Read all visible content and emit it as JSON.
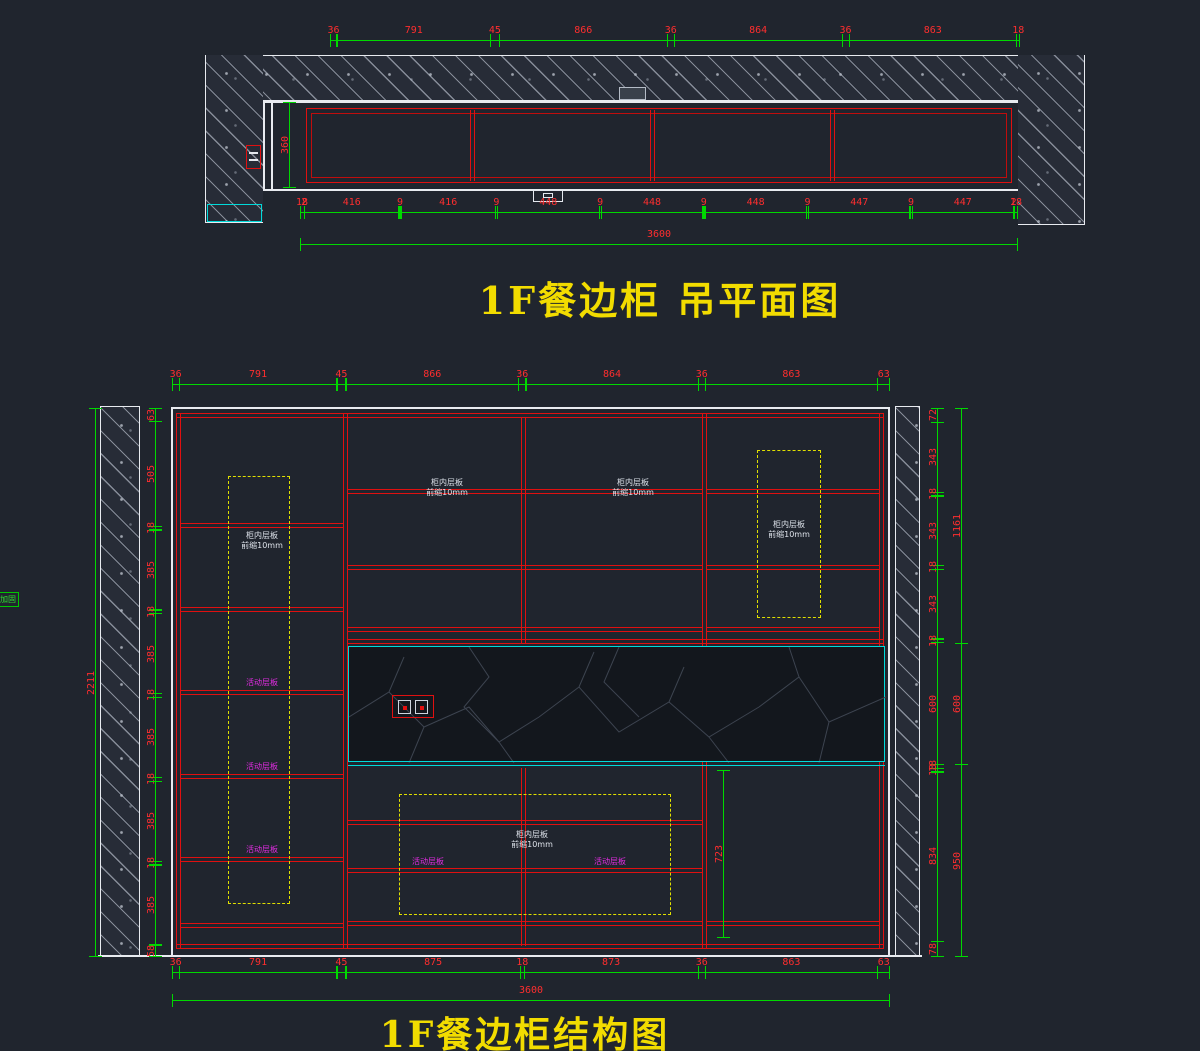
{
  "plan": {
    "title": "1F餐边柜  吊平面图",
    "dims": {
      "top": [
        "36",
        "791",
        "45",
        "866",
        "36",
        "864",
        "36",
        "863",
        "18"
      ],
      "bottom": [
        "18",
        "2",
        "416",
        "9",
        "416",
        "9",
        "448",
        "9",
        "448",
        "9",
        "448",
        "9",
        "447",
        "9",
        "447",
        "2",
        "18"
      ],
      "total": [
        "3600"
      ],
      "depth": [
        "360"
      ]
    }
  },
  "elevation": {
    "title": "1F餐边柜结构图",
    "dims": {
      "top": [
        "36",
        "791",
        "45",
        "866",
        "36",
        "864",
        "36",
        "863",
        "63"
      ],
      "bottom": [
        "36",
        "791",
        "45",
        "875",
        "18",
        "873",
        "36",
        "863",
        "63"
      ],
      "total": [
        "3600"
      ],
      "left_outer": [
        "2211"
      ],
      "left": [
        "63",
        "505",
        "18",
        "385",
        "18",
        "385",
        "18",
        "385",
        "18",
        "385",
        "18",
        "385",
        "58"
      ],
      "right": [
        "72",
        "343",
        "18",
        "343",
        "18",
        "343",
        "18",
        "600",
        "18",
        "18",
        "834",
        "78"
      ],
      "right_outer": [
        "1161",
        "600",
        "950"
      ],
      "niche": [
        "723"
      ]
    },
    "notes": {
      "shelf_line1": "柜内层板",
      "shelf_line2": "前缩10mm",
      "movable_shelf": "活动层板",
      "edge_note": "加固"
    }
  }
}
